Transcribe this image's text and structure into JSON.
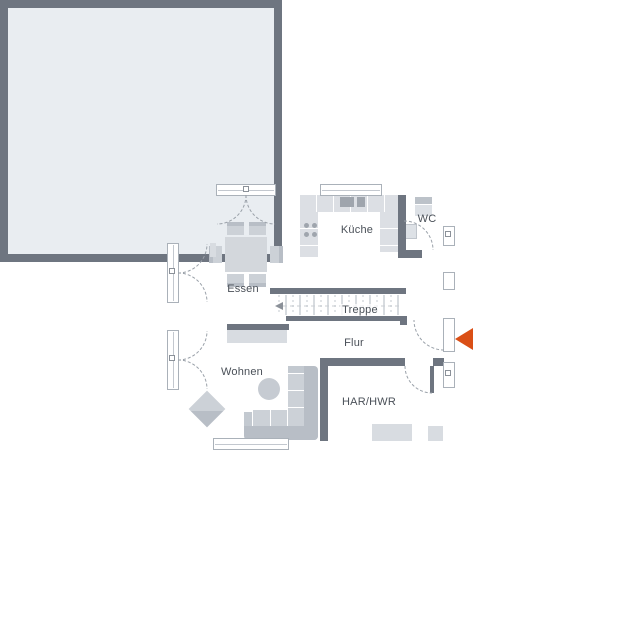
{
  "rooms": {
    "essen": {
      "label": "Essen"
    },
    "kueche": {
      "label": "Küche"
    },
    "wc": {
      "label": "WC"
    },
    "treppe": {
      "label": "Treppe"
    },
    "flur": {
      "label": "Flur"
    },
    "wohnen": {
      "label": "Wohnen"
    },
    "har_hwr": {
      "label": "HAR/HWR"
    }
  },
  "entrance": {
    "marker": "entrance-arrow",
    "direction": "left"
  },
  "colors": {
    "wall": "#6e7580",
    "floor": "#e9edf1",
    "furniture_light": "#d8dce1",
    "furniture_mid": "#ccd1d7",
    "furniture_dark": "#b8bec6",
    "outline": "#9aa1a9",
    "text": "#4a5058",
    "accent_arrow": "#da4f16"
  }
}
